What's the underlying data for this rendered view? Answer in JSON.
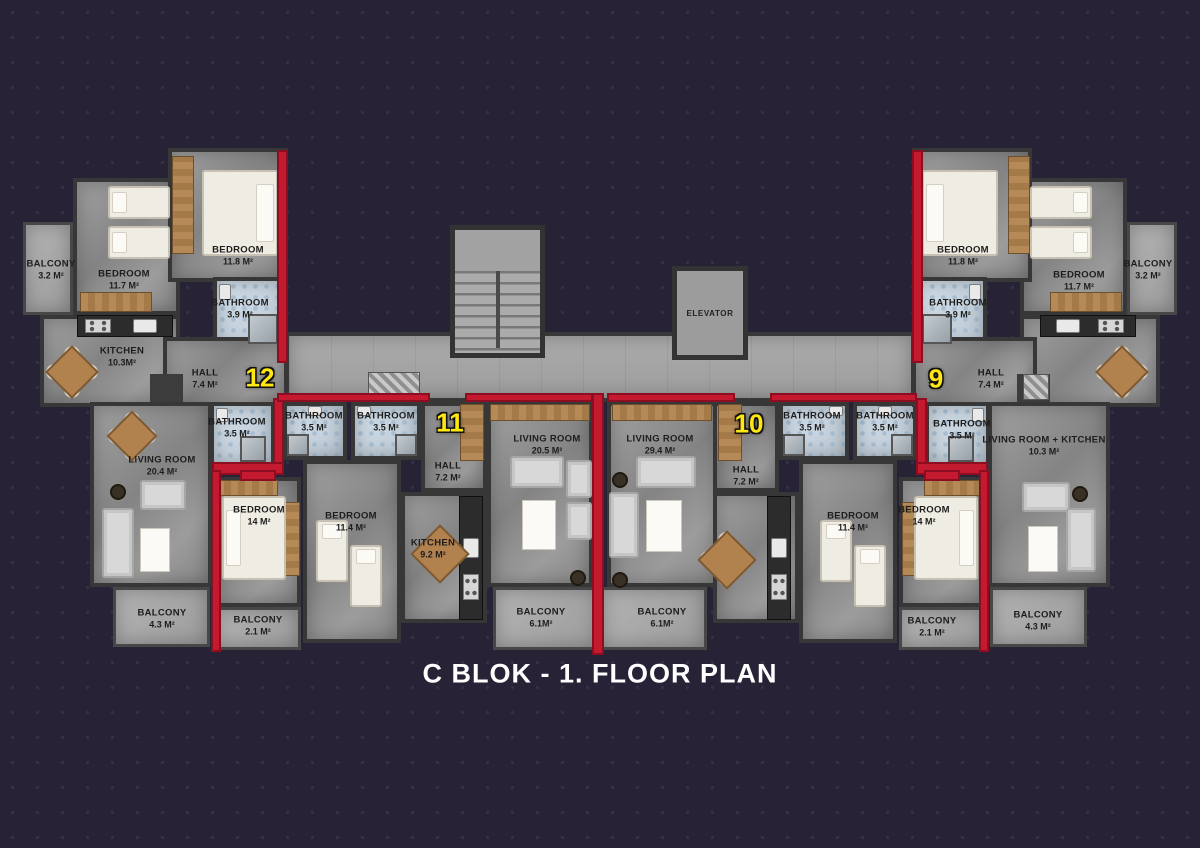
{
  "title": "C BLOK - 1. FLOOR PLAN",
  "colors": {
    "background": "#282236",
    "accent_red_wall": "#c41a30",
    "apartment_number_yellow": "#ffe812",
    "wall_dark": "#373737",
    "bathroom_blue": "#c9d7e3"
  },
  "apartments": {
    "a12": "12",
    "a11": "11",
    "a10": "10",
    "a9": "9"
  },
  "elevator": {
    "label": "ELEVATOR"
  },
  "rooms": {
    "balcony32_l": {
      "name": "BALCONY",
      "area": "3.2 M²"
    },
    "bedroom117_l": {
      "name": "BEDROOM",
      "area": "11.7 M²"
    },
    "bedroom118_l": {
      "name": "BEDROOM",
      "area": "11.8 M²"
    },
    "bathroom39_l": {
      "name": "BATHROOM",
      "area": "3.9 M²"
    },
    "kitchen103_l": {
      "name": "KITCHEN",
      "area": "10.3M²"
    },
    "hall74_l": {
      "name": "HALL",
      "area": "7.4 M²"
    },
    "bathroom35_12": {
      "name": "BATHROOM",
      "area": "3.5 M²"
    },
    "living204_l": {
      "name": "LIVING ROOM",
      "area": "20.4 M²"
    },
    "balcony43_l": {
      "name": "BALCONY",
      "area": "4.3 M²"
    },
    "bathroom35_11a": {
      "name": "BATHROOM",
      "area": "3.5 M²"
    },
    "bathroom35_11b": {
      "name": "BATHROOM",
      "area": "3.5 M²"
    },
    "hall72_l": {
      "name": "HALL",
      "area": "7.2 M²"
    },
    "bedroom14_l": {
      "name": "BEDROOM",
      "area": "14 M²"
    },
    "balcony21_l": {
      "name": "BALCONY",
      "area": "2.1 M²"
    },
    "bedroom114_l": {
      "name": "BEDROOM",
      "area": "11.4 M²"
    },
    "kitchen92_l": {
      "name": "KITCHEN",
      "area": "9.2 M²"
    },
    "living205": {
      "name": "LIVING ROOM",
      "area": "20.5 M²"
    },
    "balcony61_l": {
      "name": "BALCONY",
      "area": "6.1M²"
    },
    "living294": {
      "name": "LIVING ROOM",
      "area": "29.4 M²"
    },
    "hall72_r": {
      "name": "HALL",
      "area": "7.2 M²"
    },
    "bathroom35_10a": {
      "name": "BATHROOM",
      "area": "3.5 M²"
    },
    "bathroom35_10b": {
      "name": "BATHROOM",
      "area": "3.5 M²"
    },
    "bedroom114_r": {
      "name": "BEDROOM",
      "area": "11.4 M²"
    },
    "bedroom14_r": {
      "name": "BEDROOM",
      "area": "14 M²"
    },
    "balcony61_r": {
      "name": "BALCONY",
      "area": "6.1M²"
    },
    "balcony21_r": {
      "name": "BALCONY",
      "area": "2.1 M²"
    },
    "hall74_r": {
      "name": "HALL",
      "area": "7.4 M²"
    },
    "bathroom39_r": {
      "name": "BATHROOM",
      "area": "3.9 M²"
    },
    "bedroom118_r": {
      "name": "BEDROOM",
      "area": "11.8 M²"
    },
    "bedroom117_r": {
      "name": "BEDROOM",
      "area": "11.7 M²"
    },
    "balcony32_r": {
      "name": "BALCONY",
      "area": "3.2 M²"
    },
    "bathroom35_9": {
      "name": "BATHROOM",
      "area": "3.5 M²"
    },
    "livingkitchen_r": {
      "name": "LIVING ROOM + KITCHEN",
      "area": "10.3 M²"
    },
    "balcony43_r": {
      "name": "BALCONY",
      "area": "4.3 M²"
    }
  }
}
